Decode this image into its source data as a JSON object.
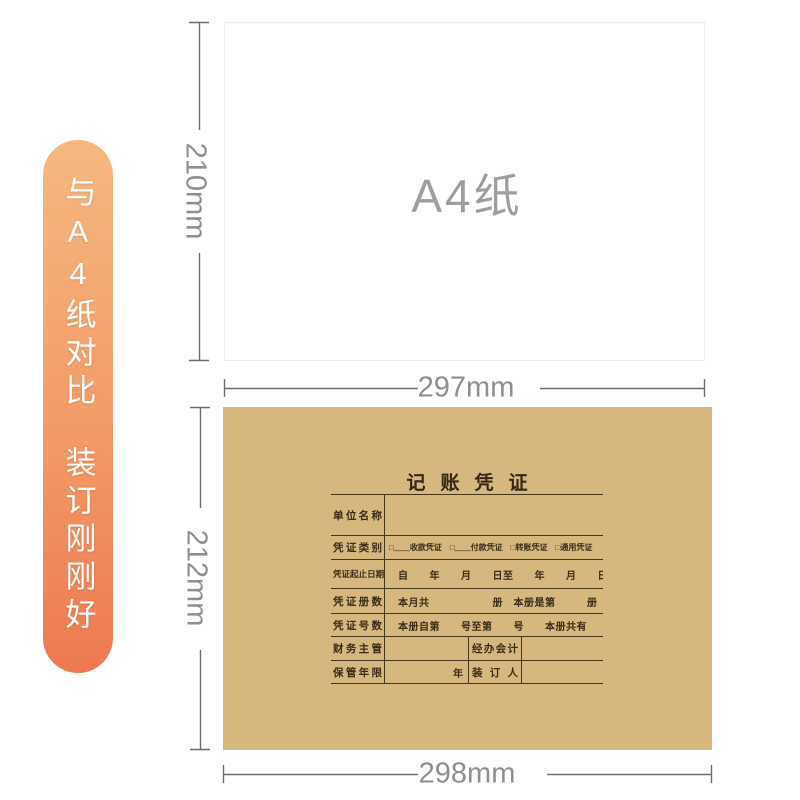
{
  "banner": {
    "line1": "与A4纸对比",
    "line2": "装订刚刚好"
  },
  "a4": {
    "label": "A4纸",
    "height_dim": "210mm",
    "width_dim": "297mm"
  },
  "voucher": {
    "title": "记账凭证",
    "height_dim": "212mm",
    "width_dim": "298mm",
    "rows": [
      {
        "label": "单位名称",
        "content": ""
      },
      {
        "label": "凭证类别",
        "content": "□____收款凭证　□____付款凭证　□转账凭证　□通用凭证"
      },
      {
        "label": "凭证起止日期",
        "content": "自　　年　　月　　日至　　年　　月　　日"
      },
      {
        "label": "凭证册数",
        "content": "本月共　　　　　　册　本册是第　　　册"
      },
      {
        "label": "凭证号数",
        "content": "本册自第　　号至第　　号　　本册共有　　号"
      },
      {
        "label": "财务主管",
        "label2": "经办会计"
      },
      {
        "label": "保管年限",
        "unit": "年",
        "label2": "装订人"
      }
    ]
  },
  "colors": {
    "ribbon_gradient_top": "#f6b87f",
    "ribbon_gradient_bottom": "#ee7950",
    "kraft_paper": "#d5b77f",
    "voucher_ink": "#3a2c15",
    "dimension_gray": "#8f8f8f"
  }
}
